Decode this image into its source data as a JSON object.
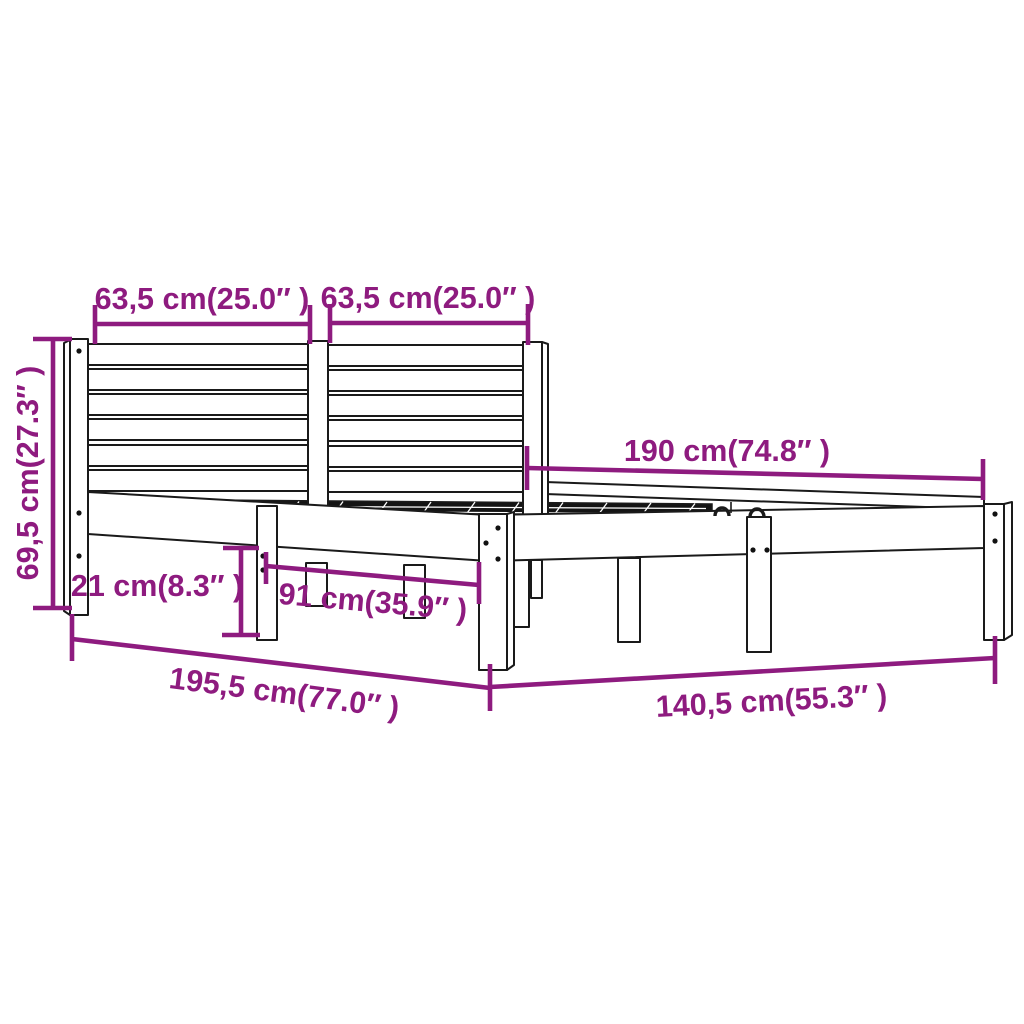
{
  "diagram": {
    "kind": "product-dimension-diagram",
    "subject": "wood-bed-frame-with-slatted-headboard",
    "colors": {
      "background": "#ffffff",
      "line_art": "#1a1a1a",
      "dimension": "#8e1b7f"
    },
    "dimensions": {
      "headboard_left_section_width": {
        "label": "63,5 cm(25.0″ )"
      },
      "headboard_right_section_width": {
        "label": "63,5 cm(25.0″ )"
      },
      "headboard_height": {
        "label": "69,5 cm(27.3″ )"
      },
      "bed_length": {
        "label": "190 cm(74.8″ )"
      },
      "leg_height": {
        "label": "21 cm(8.3″ )"
      },
      "leg_spacing": {
        "label": "91 cm(35.9″ )"
      },
      "total_length": {
        "label": "195,5 cm(77.0″ )"
      },
      "total_width": {
        "label": "140,5 cm(55.3″ )"
      }
    }
  }
}
